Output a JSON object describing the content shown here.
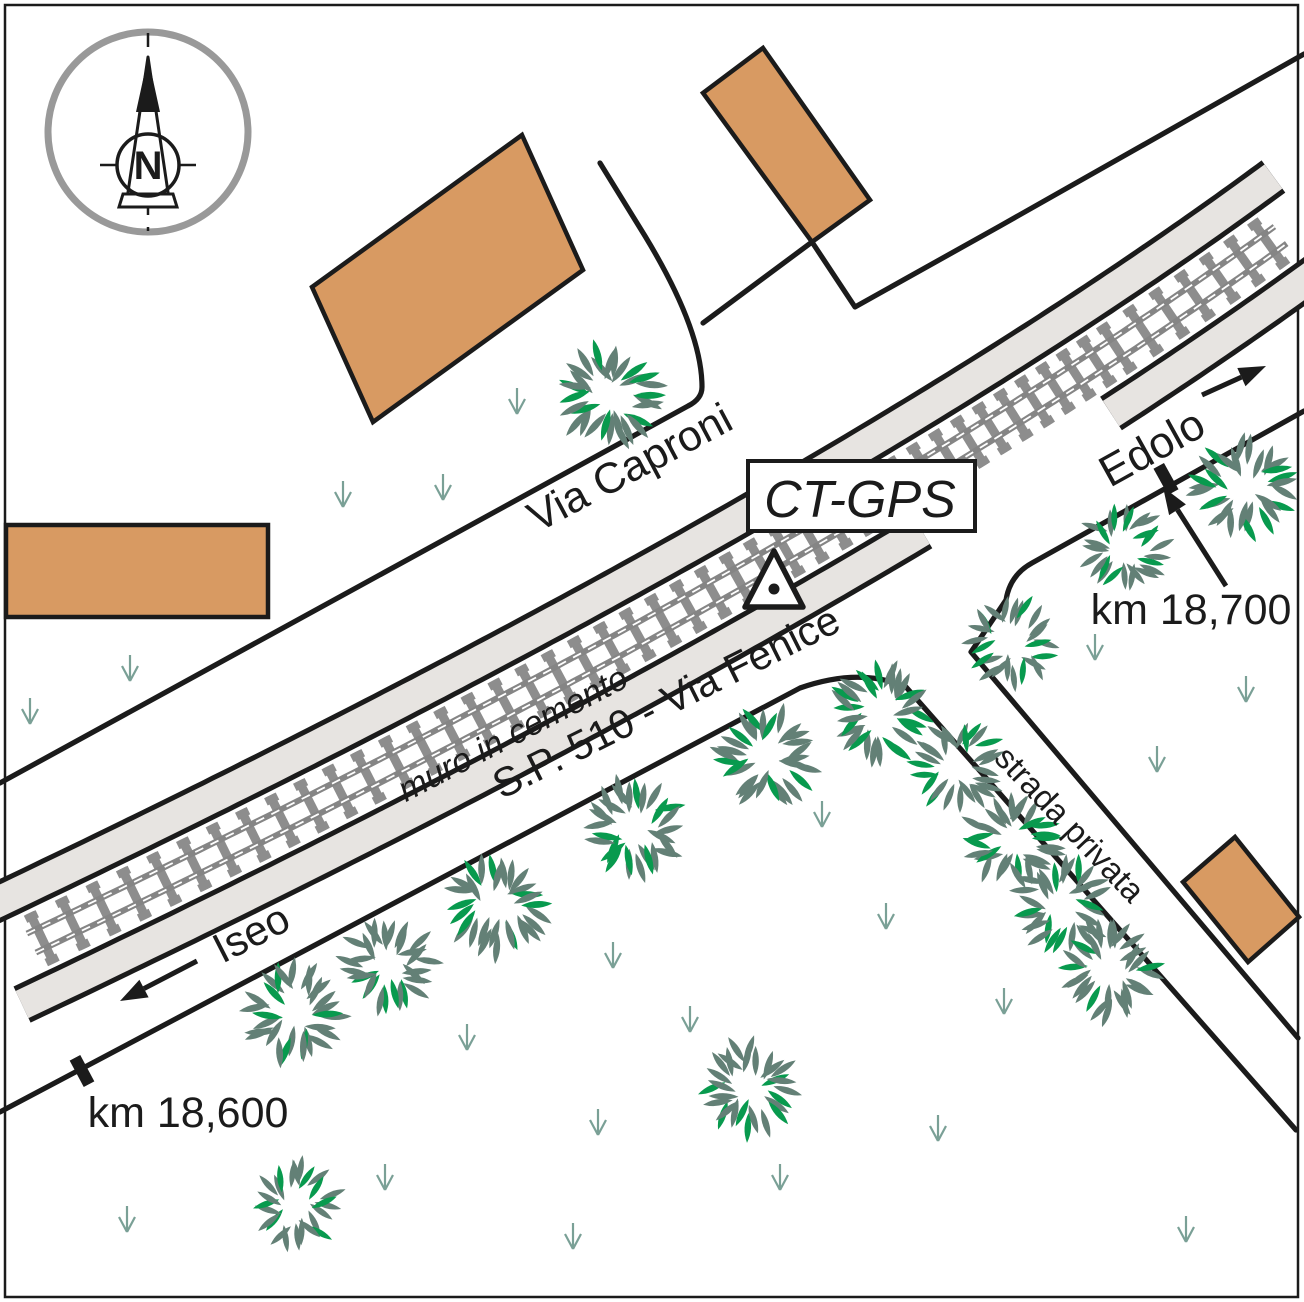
{
  "labels": {
    "via_caproni": "Via Caproni",
    "sp510": "S.P. 510 - Via Fenice",
    "muro": "muro in cemento",
    "strada_privata": "strada privata",
    "iseo": "Iseo",
    "edolo": "Edolo",
    "km18600": "km 18,600",
    "km18700": "km 18,700",
    "ctgps": "CT-GPS",
    "compass_n": "N"
  },
  "colors": {
    "ink": "#1b1b1b",
    "ballast": "#e7e4e1",
    "sleeper": "#8d8d8d",
    "rail": "#858585",
    "rail_stripe": "#ffffff",
    "building": "#d89a62",
    "leaf_gray": "#638076",
    "leaf_green": "#089a4e",
    "grass": "#7aa096",
    "compass_ring": "#999999",
    "white": "#ffffff"
  },
  "railway": {
    "p0": [
      0,
      958
    ],
    "p1": [
      840,
      560
    ],
    "p2": [
      1304,
      218
    ],
    "inner_black": [
      31.5,
      36.5
    ],
    "band": [
      36.5,
      66.5
    ],
    "outer_black": [
      66.5,
      71.5
    ],
    "se_gap": [
      898,
      1078
    ],
    "sleeper_spacing": 24,
    "sleeper_half_len": 28,
    "sleeper_half_w": 4.5,
    "rail_offset": 10.5,
    "track_x_range": [
      34,
      1272
    ],
    "rail_x_range": [
      28,
      1282
    ]
  },
  "roads": [
    {
      "name": "via-caproni-nw-edge",
      "d": "M 600 163 L 645 236 Q 702 330 702 387 Q 702 399 688 406 L 0 783"
    },
    {
      "name": "parcel-line-west",
      "d": "M 703 323 L 812 242"
    },
    {
      "name": "parcel-line-east",
      "d": "M 812 242 L 855 307 L 1000 226 L 1304 54"
    },
    {
      "name": "sp510-se-edge-and-strada-sw-edge",
      "d": "M 0 1112 L 800 688 Q 860 667 906 687 L 1296 1130"
    },
    {
      "name": "sp510-east-se-edge-and-strada-ne-edge",
      "d": "M 1304 411 L 1032 563 Q 1010 575 1006 600 L 971 652 L 1298 1038"
    }
  ],
  "buildings": [
    {
      "name": "building-left",
      "points": [
        [
          6,
          525
        ],
        [
          268,
          525
        ],
        [
          268,
          617
        ],
        [
          6,
          617
        ]
      ]
    },
    {
      "name": "building-large",
      "points": [
        [
          522,
          135
        ],
        [
          583,
          270
        ],
        [
          373,
          422
        ],
        [
          312,
          287
        ]
      ]
    },
    {
      "name": "building-tall",
      "points": [
        [
          763,
          48
        ],
        [
          870,
          200
        ],
        [
          812,
          242
        ],
        [
          703,
          93
        ]
      ]
    },
    {
      "name": "building-right",
      "points": [
        [
          1235,
          837
        ],
        [
          1299,
          917
        ],
        [
          1248,
          962
        ],
        [
          1183,
          882
        ]
      ]
    }
  ],
  "trees": [
    {
      "x": 610,
      "y": 396,
      "r": 54
    },
    {
      "x": 1125,
      "y": 549,
      "r": 46
    },
    {
      "x": 1243,
      "y": 489,
      "r": 52
    },
    {
      "x": 296,
      "y": 1014,
      "r": 52
    },
    {
      "x": 389,
      "y": 966,
      "r": 50
    },
    {
      "x": 497,
      "y": 906,
      "r": 52
    },
    {
      "x": 634,
      "y": 829,
      "r": 52
    },
    {
      "x": 766,
      "y": 757,
      "r": 52
    },
    {
      "x": 880,
      "y": 713,
      "r": 52
    },
    {
      "x": 1012,
      "y": 642,
      "r": 46
    },
    {
      "x": 958,
      "y": 765,
      "r": 48
    },
    {
      "x": 1012,
      "y": 840,
      "r": 50
    },
    {
      "x": 1062,
      "y": 905,
      "r": 50
    },
    {
      "x": 1110,
      "y": 973,
      "r": 50
    },
    {
      "x": 748,
      "y": 1087,
      "r": 50
    },
    {
      "x": 297,
      "y": 1205,
      "r": 46
    }
  ],
  "grass": [
    [
      343,
      497
    ],
    [
      443,
      490
    ],
    [
      517,
      404
    ],
    [
      30,
      714
    ],
    [
      130,
      671
    ],
    [
      822,
      817
    ],
    [
      1095,
      650
    ],
    [
      1157,
      762
    ],
    [
      1246,
      692
    ],
    [
      613,
      958
    ],
    [
      690,
      1022
    ],
    [
      886,
      919
    ],
    [
      1004,
      1004
    ],
    [
      938,
      1131
    ],
    [
      780,
      1180
    ],
    [
      467,
      1040
    ],
    [
      598,
      1125
    ],
    [
      385,
      1180
    ],
    [
      127,
      1222
    ],
    [
      573,
      1239
    ],
    [
      1186,
      1232
    ]
  ],
  "km_ticks": [
    {
      "x": 82,
      "y": 1071,
      "rot": -28
    },
    {
      "x": 1166,
      "y": 479,
      "rot": -29
    }
  ],
  "arrows": [
    {
      "name": "iseo-direction-arrow",
      "tail": [
        197,
        961
      ],
      "head": [
        120,
        1001
      ]
    },
    {
      "name": "edolo-direction-arrow",
      "tail": [
        1202,
        395
      ],
      "head": [
        1266,
        366
      ]
    },
    {
      "name": "km18700-pointer-arrow",
      "tail": [
        1226,
        586
      ],
      "head": [
        1163,
        487
      ]
    }
  ],
  "station": {
    "box": [
      748,
      461,
      227,
      70
    ],
    "triangle": [
      [
        774,
        551
      ],
      [
        745,
        607
      ],
      [
        803,
        607
      ]
    ],
    "dot": [
      774,
      589
    ]
  },
  "compass": {
    "cx": 148,
    "outer_cy": 132,
    "outer_r": 100,
    "inner_cy": 165,
    "inner_r": 31
  },
  "frame": [
    5,
    5,
    1293,
    1292
  ]
}
